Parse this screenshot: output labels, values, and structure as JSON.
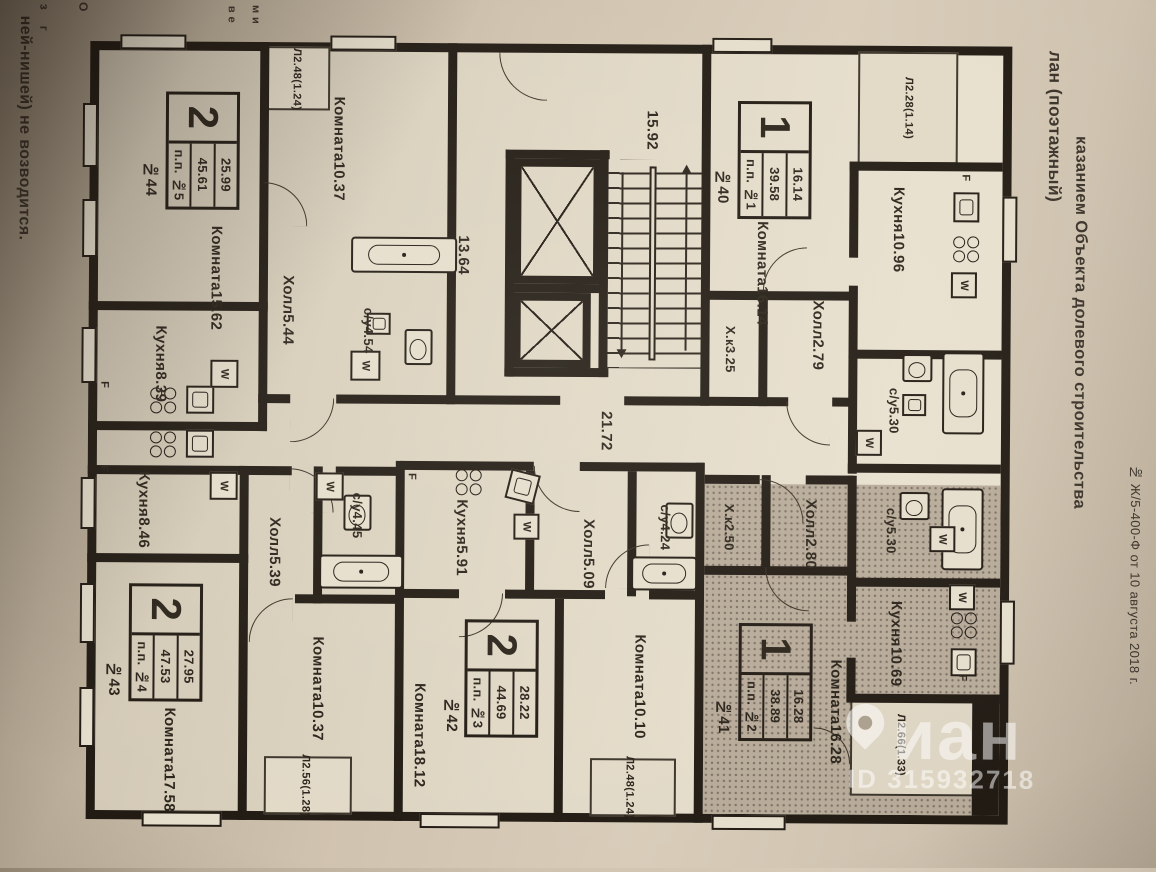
{
  "photo": {
    "left_note": "ней-нишей) не возводится.",
    "fragments": [
      "з",
      "г",
      "О",
      "в  е",
      "м  и"
    ],
    "heading_line_1": "лан (поэтажный)",
    "heading_line_2": "казанием Объекта долевого строительства",
    "doc_ref": "№ Ж/5-400-Ф от 10 августа 2018 г."
  },
  "watermark": {
    "brand": "иан",
    "id_label": "ID 315932718"
  },
  "core": {
    "stairwell": "15.92",
    "lift_hall": "13.64",
    "corridor": "21.72"
  },
  "legend": {
    "washer": "W",
    "fridge": "F"
  },
  "apartments": {
    "a44": {
      "apt_no": "№44",
      "badge": {
        "rooms": "2",
        "living": "25.99",
        "total": "45.61",
        "unit": "п.п. №5"
      },
      "room1": {
        "name": "Комната",
        "value": "15.62"
      },
      "room2": {
        "name": "Комната",
        "value": "10.37"
      },
      "hall": {
        "name": "Холл",
        "value": "5.44"
      },
      "bath": {
        "name": "с/у",
        "value": "4.54"
      },
      "kitchen": {
        "name": "Кухня",
        "value": "8.39"
      },
      "balcony": {
        "name": "Л",
        "value": "2.48",
        "coef": "(1.24)"
      }
    },
    "a40": {
      "apt_no": "№40",
      "badge": {
        "rooms": "1",
        "living": "16.14",
        "total": "39.58",
        "unit": "п.п. №1"
      },
      "room": {
        "name": "Комната",
        "value": "16.14"
      },
      "kitchen": {
        "name": "Кухня",
        "value": "10.96"
      },
      "hall": {
        "name": "Холл",
        "value": "2.79"
      },
      "pantry": {
        "name": "Х.к",
        "value": "3.25"
      },
      "bath": {
        "name": "с/у",
        "value": "5.30"
      },
      "balcony": {
        "name": "Л",
        "value": "2.28",
        "coef": "(1.14)"
      }
    },
    "a41": {
      "apt_no": "№41",
      "badge": {
        "rooms": "1",
        "living": "16.28",
        "total": "38.89",
        "unit": "п.п. №2"
      },
      "room": {
        "name": "Комната",
        "value": "16.28"
      },
      "kitchen": {
        "name": "Кухня",
        "value": "10.69"
      },
      "hall": {
        "name": "Холл",
        "value": "2.80"
      },
      "pantry": {
        "name": "Х.к",
        "value": "2.50"
      },
      "bath": {
        "name": "с/у",
        "value": "5.30"
      },
      "balcony": {
        "name": "Л",
        "value": "2.66",
        "coef": "(1.33)"
      }
    },
    "a42": {
      "apt_no": "№42",
      "badge": {
        "rooms": "2",
        "living": "28.22",
        "total": "44.69",
        "unit": "п.п. №3"
      },
      "room1": {
        "name": "Комната",
        "value": "18.12"
      },
      "room2": {
        "name": "Комната",
        "value": "10.10"
      },
      "kitchen": {
        "name": "Кухня",
        "value": "5.91"
      },
      "hall": {
        "name": "Холл",
        "value": "5.09"
      },
      "bath": {
        "name": "с/у",
        "value": "4.24"
      },
      "balcony": {
        "name": "Л",
        "value": "2.48",
        "coef": "(1.24)"
      }
    },
    "a43": {
      "apt_no": "№43",
      "badge": {
        "rooms": "2",
        "living": "27.95",
        "total": "47.53",
        "unit": "п.п. №4"
      },
      "room1": {
        "name": "Комната",
        "value": "17.58"
      },
      "room2": {
        "name": "Комната",
        "value": "10.37"
      },
      "kitchen": {
        "name": "Кухня",
        "value": "8.46"
      },
      "hall": {
        "name": "Холл",
        "value": "5.39"
      },
      "bath": {
        "name": "с/у",
        "value": "4.45"
      },
      "balcony": {
        "name": "Л",
        "value": "2.56",
        "coef": "(1.28)"
      }
    }
  }
}
